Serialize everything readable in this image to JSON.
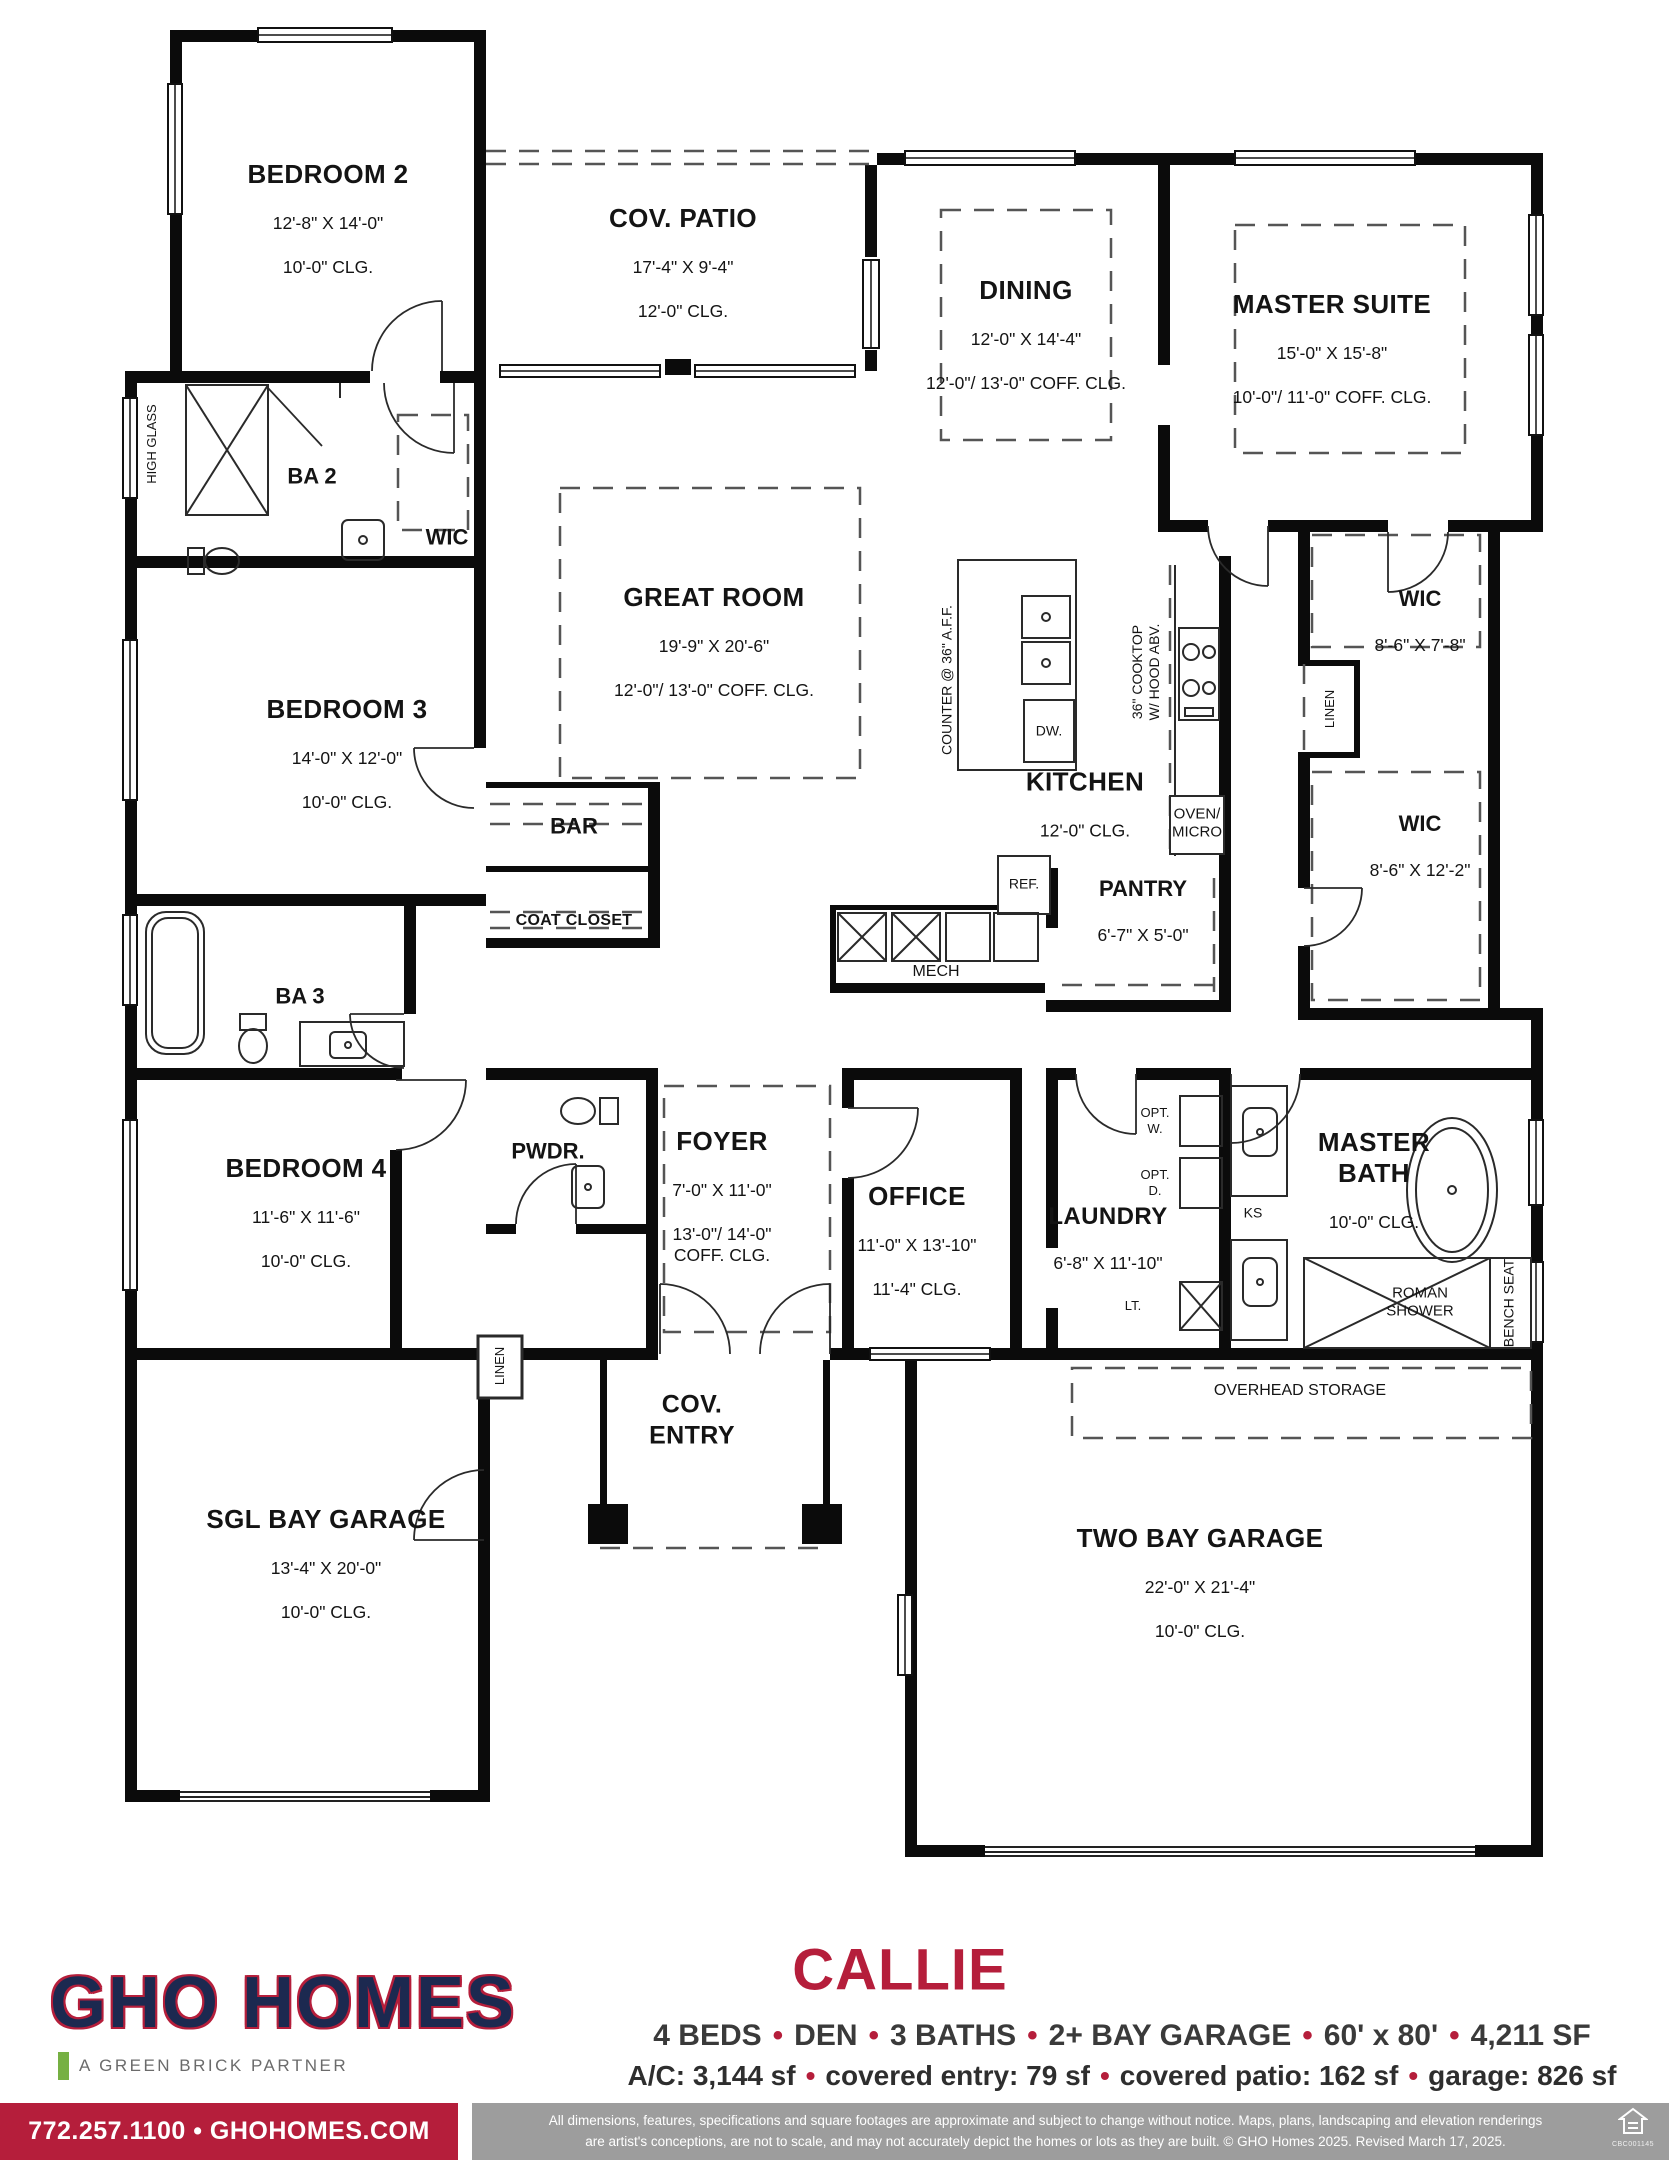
{
  "plan": {
    "rooms": {
      "bedroom2": {
        "name": "BEDROOM 2",
        "dim": "12'-8\" X 14'-0\"",
        "clg": "10'-0\" CLG."
      },
      "covPatio": {
        "name": "COV. PATIO",
        "dim": "17'-4\" X 9'-4\"",
        "clg": "12'-0\" CLG."
      },
      "dining": {
        "name": "DINING",
        "dim": "12'-0\" X 14'-4\"",
        "clg": "12'-0\"/ 13'-0\" COFF. CLG."
      },
      "masterSuite": {
        "name": "MASTER SUITE",
        "dim": "15'-0\" X 15'-8\"",
        "clg": "10'-0\"/ 11'-0\" COFF. CLG."
      },
      "greatRoom": {
        "name": "GREAT ROOM",
        "dim": "19'-9\" X 20'-6\"",
        "clg": "12'-0\"/ 13'-0\" COFF. CLG."
      },
      "bedroom3": {
        "name": "BEDROOM 3",
        "dim": "14'-0\" X 12'-0\"",
        "clg": "10'-0\" CLG."
      },
      "bedroom4": {
        "name": "BEDROOM 4",
        "dim": "11'-6\" X 11'-6\"",
        "clg": "10'-0\" CLG."
      },
      "kitchen": {
        "name": "KITCHEN",
        "clg": "12'-0\" CLG."
      },
      "pantry": {
        "name": "PANTRY",
        "dim": "6'-7\" X 5'-0\""
      },
      "wicMaster1": {
        "name": "WIC",
        "dim": "8'-6\" X 7'-8\""
      },
      "wicMaster2": {
        "name": "WIC",
        "dim": "8'-6\" X 12'-2\""
      },
      "wicBed2": {
        "name": "WIC"
      },
      "ba2": {
        "name": "BA 2"
      },
      "ba3": {
        "name": "BA 3"
      },
      "bar": {
        "name": "BAR"
      },
      "coatCloset": {
        "name": "COAT CLOSET"
      },
      "pwdr": {
        "name": "PWDR."
      },
      "foyer": {
        "name": "FOYER",
        "dim": "7'-0\" X 11'-0\"",
        "clg": "13'-0\"/ 14'-0\"\nCOFF. CLG."
      },
      "office": {
        "name": "OFFICE",
        "dim": "11'-0\" X 13'-10\"",
        "clg": "11'-4\" CLG."
      },
      "laundry": {
        "name": "LAUNDRY",
        "dim": "6'-8\" X 11'-10\""
      },
      "masterBath": {
        "name": "MASTER\nBATH",
        "clg": "10'-0\" CLG."
      },
      "covEntry": {
        "name": "COV.\nENTRY"
      },
      "sglGarage": {
        "name": "SGL BAY GARAGE",
        "dim": "13'-4\" X 20'-0\"",
        "clg": "10'-0\" CLG."
      },
      "twoBayGarage": {
        "name": "TWO BAY GARAGE",
        "dim": "22'-0\" X 21'-4\"",
        "clg": "10'-0\" CLG."
      }
    },
    "annotations": {
      "highGlass": "HIGH GLASS",
      "counter": "COUNTER @ 36\" A.F.F.",
      "cooktop": "36\" COOKTOP\nW/ HOOD ABV.",
      "ovenMicro": "OVEN/\nMICRO",
      "dw": "DW.",
      "ref": "REF.",
      "mech": "MECH",
      "linen1": "LINEN",
      "linen2": "LINEN",
      "optW": "OPT.\nW.",
      "optD": "OPT.\nD.",
      "lt": "LT.",
      "ks": "KS",
      "romanShower": "ROMAN\nSHOWER",
      "benchSeat": "BENCH SEAT",
      "overheadStorage": "OVERHEAD STORAGE"
    }
  },
  "footer": {
    "brand": "GHO HOMES",
    "partner": "A GREEN BRICK PARTNER",
    "contact": "772.257.1100 • GHOHOMES.COM",
    "planName": "CALLIE",
    "specs": [
      "4 BEDS",
      "DEN",
      "3 BATHS",
      "2+ BAY GARAGE",
      "60' x 80'",
      "4,211 SF"
    ],
    "areas": [
      "A/C: 3,144 sf",
      "covered entry: 79 sf",
      "covered patio: 162 sf",
      "garage: 826 sf"
    ],
    "disclaimer1": "All dimensions, features, specifications and square footages are approximate and subject to change without notice. Maps, plans, landscaping and elevation renderings",
    "disclaimer2": "are artist's conceptions, are not to scale, and may not accurately depict the homes or lots as they are built. © GHO Homes 2025. Revised March 17, 2025.",
    "license": "CBC001145"
  },
  "colors": {
    "accent": "#b51e3b",
    "navy": "#1c2950",
    "green": "#76b043",
    "grayBar": "#9d9d9d"
  }
}
